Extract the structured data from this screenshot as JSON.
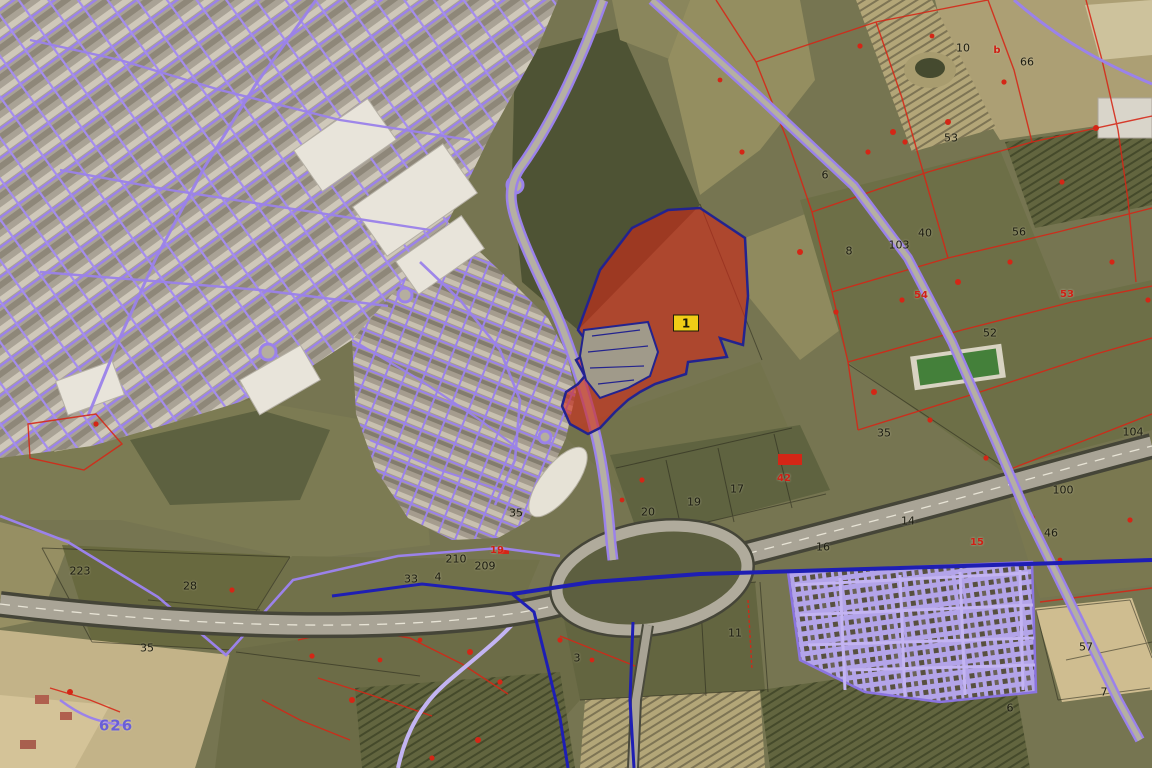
{
  "map": {
    "marker": {
      "text": "1",
      "x": 686,
      "y": 323
    },
    "labels": [
      {
        "text": "223",
        "x": 80,
        "y": 571,
        "c": "b"
      },
      {
        "text": "28",
        "x": 190,
        "y": 586,
        "c": "b"
      },
      {
        "text": "35",
        "x": 147,
        "y": 648,
        "c": "b"
      },
      {
        "text": "33",
        "x": 411,
        "y": 579,
        "c": "b"
      },
      {
        "text": "4",
        "x": 438,
        "y": 577,
        "c": "b"
      },
      {
        "text": "210",
        "x": 456,
        "y": 559,
        "c": "b"
      },
      {
        "text": "209",
        "x": 485,
        "y": 566,
        "c": "b"
      },
      {
        "text": "19",
        "x": 497,
        "y": 551,
        "c": "r"
      },
      {
        "text": "35",
        "x": 516,
        "y": 513,
        "c": "b"
      },
      {
        "text": "20",
        "x": 648,
        "y": 512,
        "c": "b"
      },
      {
        "text": "19",
        "x": 694,
        "y": 502,
        "c": "b"
      },
      {
        "text": "17",
        "x": 737,
        "y": 489,
        "c": "b"
      },
      {
        "text": "42",
        "x": 784,
        "y": 479,
        "c": "r"
      },
      {
        "text": "16",
        "x": 823,
        "y": 547,
        "c": "b"
      },
      {
        "text": "14",
        "x": 908,
        "y": 521,
        "c": "b"
      },
      {
        "text": "11",
        "x": 735,
        "y": 633,
        "c": "b"
      },
      {
        "text": "3",
        "x": 577,
        "y": 658,
        "c": "b"
      },
      {
        "text": "6",
        "x": 825,
        "y": 175,
        "c": "b"
      },
      {
        "text": "8",
        "x": 849,
        "y": 251,
        "c": "b"
      },
      {
        "text": "103",
        "x": 899,
        "y": 245,
        "c": "b"
      },
      {
        "text": "40",
        "x": 925,
        "y": 233,
        "c": "b"
      },
      {
        "text": "56",
        "x": 1019,
        "y": 232,
        "c": "b"
      },
      {
        "text": "53",
        "x": 951,
        "y": 138,
        "c": "b"
      },
      {
        "text": "10",
        "x": 963,
        "y": 48,
        "c": "b"
      },
      {
        "text": "b",
        "x": 997,
        "y": 51,
        "c": "r"
      },
      {
        "text": "66",
        "x": 1027,
        "y": 62,
        "c": "b"
      },
      {
        "text": "52",
        "x": 990,
        "y": 333,
        "c": "b"
      },
      {
        "text": "54",
        "x": 921,
        "y": 296,
        "c": "r"
      },
      {
        "text": "53",
        "x": 1067,
        "y": 295,
        "c": "r"
      },
      {
        "text": "35",
        "x": 884,
        "y": 433,
        "c": "b"
      },
      {
        "text": "104",
        "x": 1133,
        "y": 432,
        "c": "b"
      },
      {
        "text": "100",
        "x": 1063,
        "y": 490,
        "c": "b"
      },
      {
        "text": "46",
        "x": 1051,
        "y": 533,
        "c": "b"
      },
      {
        "text": "15",
        "x": 977,
        "y": 543,
        "c": "r"
      },
      {
        "text": "57",
        "x": 1086,
        "y": 647,
        "c": "b"
      },
      {
        "text": "7",
        "x": 1104,
        "y": 692,
        "c": "b"
      },
      {
        "text": "6",
        "x": 1010,
        "y": 708,
        "c": "b"
      },
      {
        "text": "626",
        "x": 116,
        "y": 726,
        "c": "u"
      }
    ],
    "colors": {
      "highlight_parcel_fill": "#d22818",
      "highlight_parcel_outline": "#23238f",
      "cadastral_purple": "#9b82ea",
      "cadastral_red": "#d62616",
      "utility_navy": "#1e1eb4",
      "marker_bg": "#f0cd16",
      "label_black": "#1b1b10",
      "label_blue": "#6a5fd8"
    }
  }
}
